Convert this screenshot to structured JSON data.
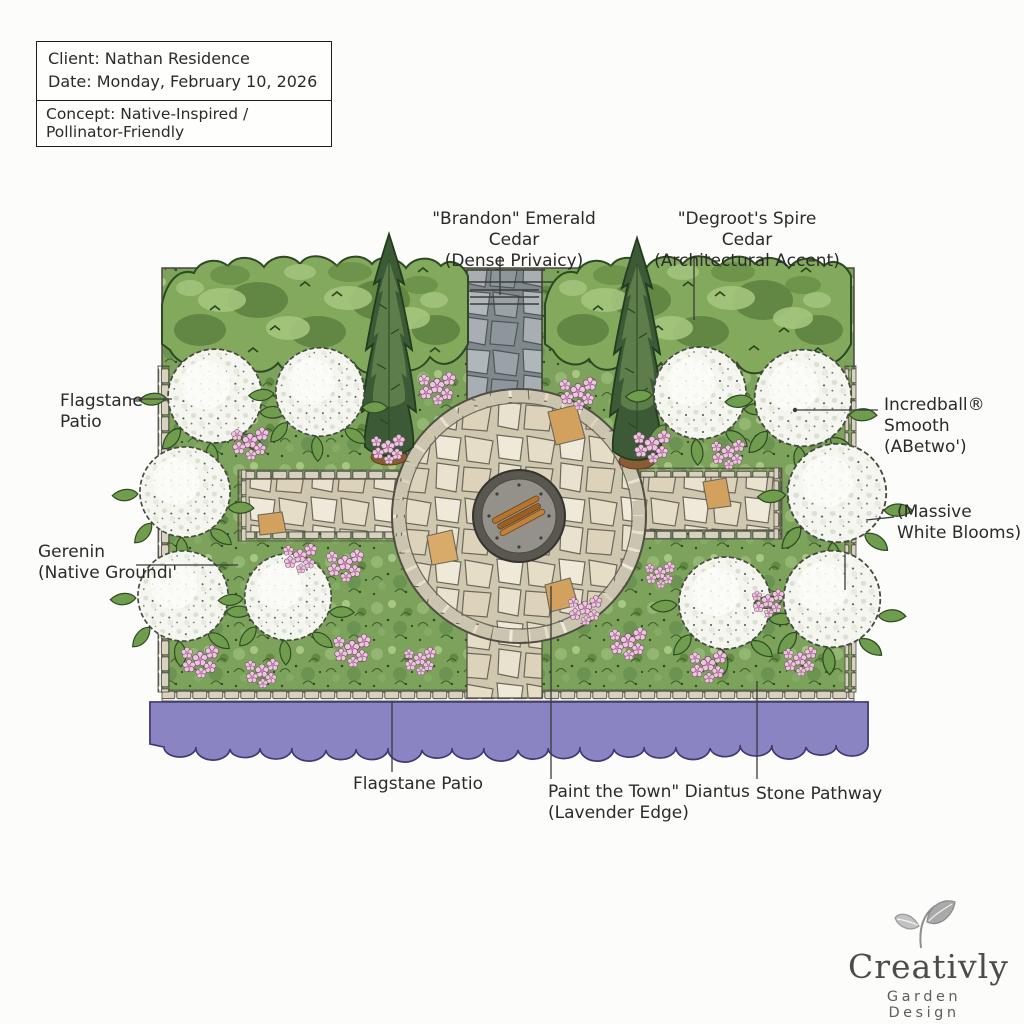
{
  "header": {
    "client": "Client: Nathan Residence",
    "date": "Date: Monday, February 10, 2026",
    "concept": "Concept: Native-Inspired / Pollinator-Friendly"
  },
  "plan_labels": {
    "brandon_cedar": {
      "line1": "\"Brandon\" Emerald Cedar",
      "line2": "(Dense Privaicy)"
    },
    "degroot_cedar": {
      "line1": "\"Degroot's Spire Cedar",
      "line2": "(Architectural Accent)"
    },
    "flagstone_patio_left": {
      "line1": "Flagstane",
      "line2": "Patio"
    },
    "geranium_groundcover": {
      "line1": "Gerenin",
      "line2": "(Native Groundı'"
    },
    "incrediball_hydrangea": {
      "line1": "Incredball®",
      "line2": "Smooth",
      "line3": "(ABetwo')"
    },
    "massive_white_blooms": {
      "line1": "(Massive",
      "line2": "White Blooms)"
    },
    "flagstone_patio_bottom": "Flagstane Patio",
    "dianthus_edge": {
      "line1": "Paint the Town\" Diantus",
      "line2": "(Lavender Edge)"
    },
    "stone_pathway": "Stone Pathway"
  },
  "logo": {
    "name": "Creativly",
    "tagline": "Garden Design"
  },
  "colors": {
    "ink": "#2a2a2a",
    "hedge_green": "#83aa5c",
    "cedar_green": "#3c5a36",
    "groundcover_green": "#7ca25b",
    "bloom_white": "#f6f6f1",
    "flower_pink": "#ecc6de",
    "lavender_purple": "#8a84c2",
    "stone_beige": "#e7dfcb",
    "stone_gray": "#9aa3a8",
    "firewood_orange": "#b5742f",
    "logo_gray": "#8f8f8f"
  }
}
